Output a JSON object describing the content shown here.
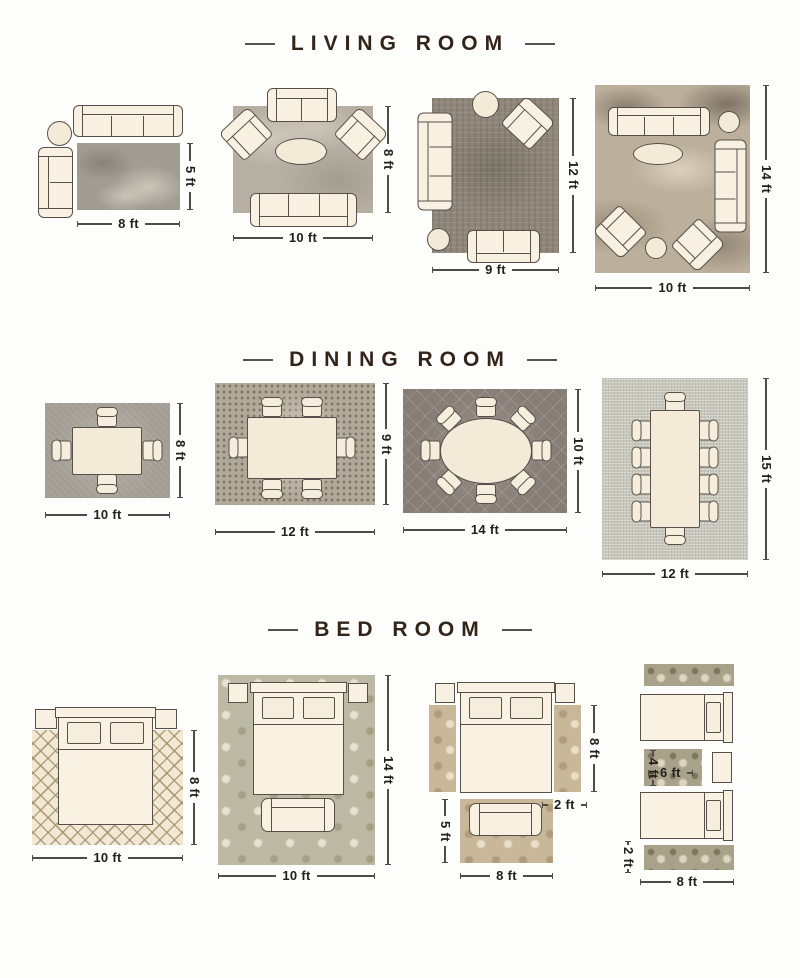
{
  "sections": {
    "living": {
      "title": "LIVING ROOM",
      "l1": {
        "w": "8 ft",
        "h": "5 ft"
      },
      "l2": {
        "w": "10 ft",
        "h": "8 ft"
      },
      "l3": {
        "w": "9 ft",
        "h": "12 ft"
      },
      "l4": {
        "w": "10 ft",
        "h": "14 ft"
      }
    },
    "dining": {
      "title": "DINING ROOM",
      "d1": {
        "w": "10 ft",
        "h": "8 ft"
      },
      "d2": {
        "w": "12 ft",
        "h": "9 ft"
      },
      "d3": {
        "w": "14 ft",
        "h": "10 ft"
      },
      "d4": {
        "w": "12 ft",
        "h": "15 ft"
      }
    },
    "bed": {
      "title": "BED ROOM",
      "b1": {
        "w": "10 ft",
        "h": "8 ft"
      },
      "b2": {
        "w": "10 ft",
        "h": "14 ft"
      },
      "b3": {
        "side_runner_h": "8 ft",
        "side_runner_w": "2 ft",
        "foot_rug_h": "5 ft",
        "foot_rug_w": "8 ft"
      },
      "b4": {
        "between_rug_h": "4 ft",
        "between_rug_w": "6 ft",
        "runner_h": "2 ft",
        "runner_w": "8 ft"
      }
    }
  },
  "colors": {
    "background": "#fdfdfb",
    "title_text": "#33241a",
    "dimension_text": "#23201c",
    "furniture_fill": "#f8f1e1",
    "furniture_outline": "#57504a"
  }
}
